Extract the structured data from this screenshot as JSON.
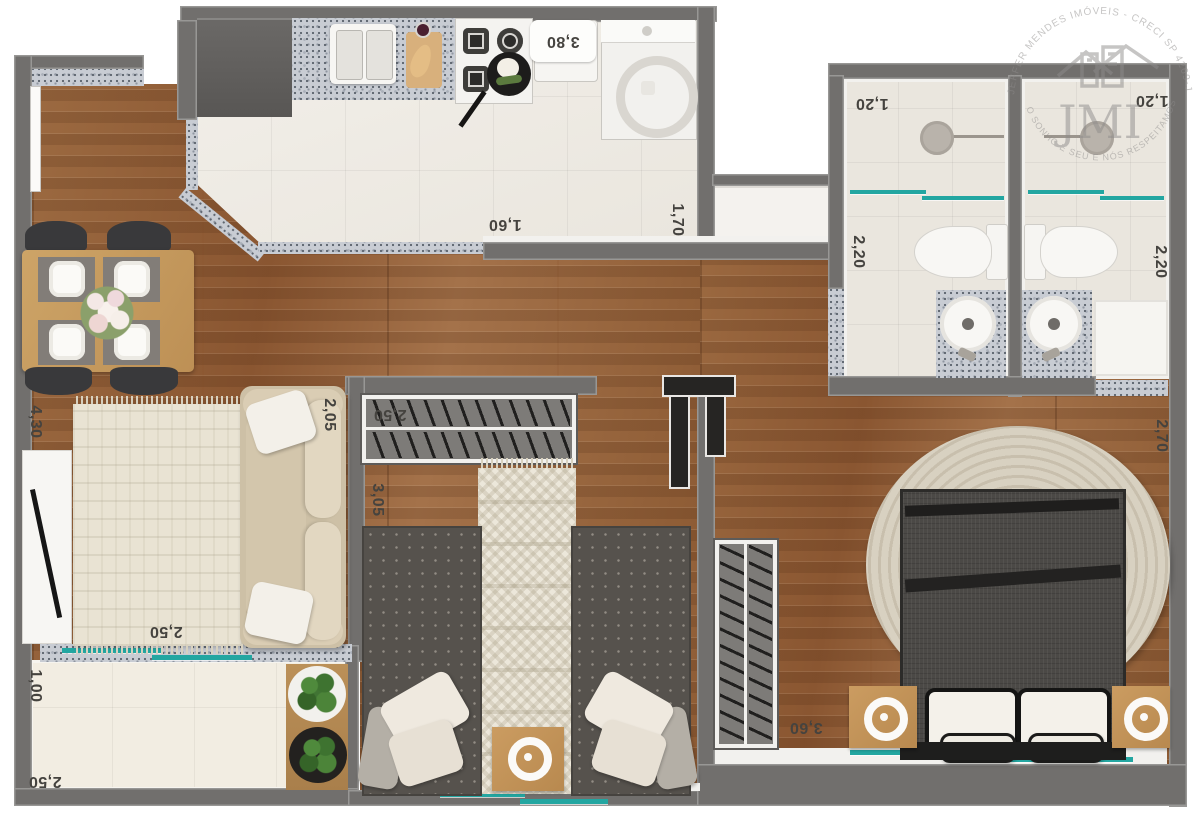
{
  "watermark": {
    "brand": "JMI",
    "arc_top": "JEFFER MENDES IMÓVEIS - CRECI SP 4269-J",
    "arc_bottom": "O SONHO É SEU E NÓS RESPEITAMOS ISSO"
  },
  "colors": {
    "wall": "#716f6d",
    "wood": "#935f38",
    "teal": "#23a6a1",
    "granite": "#c8ccd3",
    "label": "#45433f"
  },
  "labels": {
    "kitchen_width": "3,80",
    "kitchen_depth": "1,60",
    "service_depth": "1,70",
    "bath1_width": "1,20",
    "bath1_depth": "2,20",
    "bath2_width": "1,20",
    "bath2_depth": "2,20",
    "living_length": "4,30",
    "sofa_length": "2,05",
    "bedroom2_closet_width": "2,50",
    "bedroom2_depth": "3,05",
    "living_width": "2,50",
    "balcony_depth": "1,00",
    "balcony_width": "2,50",
    "master_closet_width": "3,60",
    "master_depth": "2,70"
  }
}
